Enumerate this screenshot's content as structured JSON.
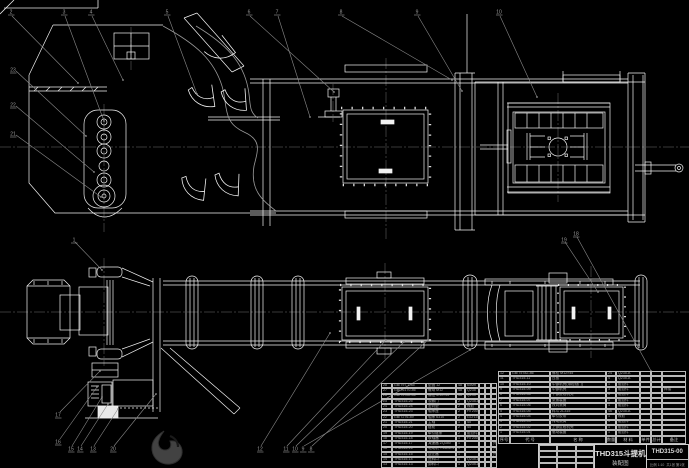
{
  "colors": {
    "background": "#000000",
    "line": "#f2f2f2",
    "leader": "#8a8a8a",
    "centerline": "#6f6f6f",
    "table_text": "#a8a8a8",
    "watermark": "#424242"
  },
  "title_block": {
    "title": "THD315斗提机",
    "subtitle": "装配图",
    "drawing_no": "THD315-00",
    "scale_note": "比例 1:10",
    "sheet_note": "共1张 第1张"
  },
  "bom": {
    "header": [
      "序号",
      "代  号",
      "名  称",
      "数量",
      "材 料",
      "单件",
      "总计",
      "备注"
    ],
    "right_rows": [
      [
        "12",
        "GB/T5782-86",
        "螺栓 M12×45",
        "24",
        "Q235-A",
        "",
        "",
        ""
      ],
      [
        "11",
        "THD315-11",
        "压板",
        "4",
        "Q235-A",
        "",
        "",
        ""
      ],
      [
        "10",
        "THD315-10",
        "中部机壳(带检视门)",
        "1",
        "组合件",
        "",
        "",
        ""
      ],
      [
        "9",
        "THD315-09",
        "中部机壳",
        "3",
        "组合件",
        "",
        "",
        "焊接"
      ],
      [
        "8",
        "THD315-08",
        "下部区段机壳",
        "1",
        "组合件",
        "",
        "",
        ""
      ],
      [
        "7",
        "THD315-07",
        "张紧装置",
        "1",
        "组合件",
        "",
        "",
        ""
      ],
      [
        "6",
        "THD315-06",
        "改向滚筒",
        "1",
        "组合件",
        "",
        "",
        ""
      ],
      [
        "5",
        "THD315-05",
        "料斗 ZL315",
        "46",
        "Q235-A",
        "",
        "",
        ""
      ],
      [
        "4",
        "THD315-04",
        "牵引胶带",
        "1",
        "橡胶",
        "",
        "",
        ""
      ],
      [
        "3",
        "THD315-03",
        "传动滚筒",
        "1",
        "组合件",
        "",
        "",
        ""
      ],
      [
        "2",
        "THD315-02",
        "上部区段机壳",
        "1",
        "组合件",
        "",
        "",
        ""
      ],
      [
        "1",
        "THD315-01",
        "驱动装置",
        "1",
        "组合件",
        "",
        "",
        ""
      ]
    ],
    "left_rows": [
      [
        "28",
        "GB/T97.1-85",
        "垫圈 12",
        "48",
        "65Mn",
        "",
        "",
        ""
      ],
      [
        "27",
        "GB/T6170-86",
        "螺母 M12",
        "48",
        "Q235",
        "",
        "",
        ""
      ],
      [
        "26",
        "GB/T5782-86",
        "螺栓 M10×35",
        "36",
        "Q235",
        "",
        "",
        ""
      ],
      [
        "25",
        "THD315-25",
        "观察门",
        "2",
        "Q235-A",
        "",
        "",
        ""
      ],
      [
        "24",
        "THD315-24",
        "密封垫",
        "2",
        "橡胶",
        "",
        "",
        ""
      ],
      [
        "23",
        "THD315-23",
        "轴承座",
        "2",
        "HT200",
        "",
        "",
        ""
      ],
      [
        "22",
        "GB/T276-89",
        "轴承 6310",
        "2",
        "GCr15",
        "",
        "",
        ""
      ],
      [
        "21",
        "THD315-21",
        "主轴",
        "1",
        "45",
        "",
        "",
        ""
      ],
      [
        "20",
        "THD315-20",
        "链轮",
        "2",
        "45",
        "",
        "",
        ""
      ],
      [
        "19",
        "THD315-19",
        "牵引链条",
        "2",
        "组合件",
        "",
        "",
        ""
      ],
      [
        "18",
        "THD315-18",
        "联轴器",
        "1",
        "HT200",
        "",
        "",
        ""
      ],
      [
        "17",
        "THD315-17",
        "减速器 ZQ350",
        "1",
        "",
        "",
        "",
        "外购"
      ],
      [
        "16",
        "THD315-16",
        "电动机 Y132M-4",
        "1",
        "",
        "",
        "",
        "外购"
      ],
      [
        "15",
        "THD315-15",
        "逆止器",
        "1",
        "",
        "",
        "",
        "外购"
      ],
      [
        "14",
        "THD315-14",
        "进料口",
        "1",
        "Q235-A",
        "",
        "",
        ""
      ],
      [
        "13",
        "THD315-13",
        "卸料口",
        "1",
        "Q235-A",
        "",
        "",
        ""
      ]
    ]
  },
  "balloons": [
    {
      "x": 11,
      "y": 12,
      "label": "2"
    },
    {
      "x": 64,
      "y": 12,
      "label": "3"
    },
    {
      "x": 91,
      "y": 12,
      "label": "4"
    },
    {
      "x": 167,
      "y": 12,
      "label": "5"
    },
    {
      "x": 249,
      "y": 12,
      "label": "6"
    },
    {
      "x": 277,
      "y": 12,
      "label": "7"
    },
    {
      "x": 341,
      "y": 12,
      "label": "8"
    },
    {
      "x": 417,
      "y": 12,
      "label": "9"
    },
    {
      "x": 499,
      "y": 12,
      "label": "10"
    },
    {
      "x": 13,
      "y": 70,
      "label": "23"
    },
    {
      "x": 13,
      "y": 105,
      "label": "22"
    },
    {
      "x": 13,
      "y": 134,
      "label": "21"
    },
    {
      "x": 74,
      "y": 240,
      "label": "1"
    },
    {
      "x": 564,
      "y": 240,
      "label": "19"
    },
    {
      "x": 576,
      "y": 234,
      "label": "18"
    },
    {
      "x": 58,
      "y": 415,
      "label": "17"
    },
    {
      "x": 58,
      "y": 442,
      "label": "16"
    },
    {
      "x": 71,
      "y": 449,
      "label": "15"
    },
    {
      "x": 80,
      "y": 449,
      "label": "14"
    },
    {
      "x": 93,
      "y": 449,
      "label": "13"
    },
    {
      "x": 113,
      "y": 449,
      "label": "20"
    },
    {
      "x": 260,
      "y": 449,
      "label": "12"
    },
    {
      "x": 286,
      "y": 449,
      "label": "11"
    },
    {
      "x": 295,
      "y": 449,
      "label": "10"
    },
    {
      "x": 303,
      "y": 449,
      "label": "9"
    },
    {
      "x": 311,
      "y": 449,
      "label": "8"
    }
  ]
}
